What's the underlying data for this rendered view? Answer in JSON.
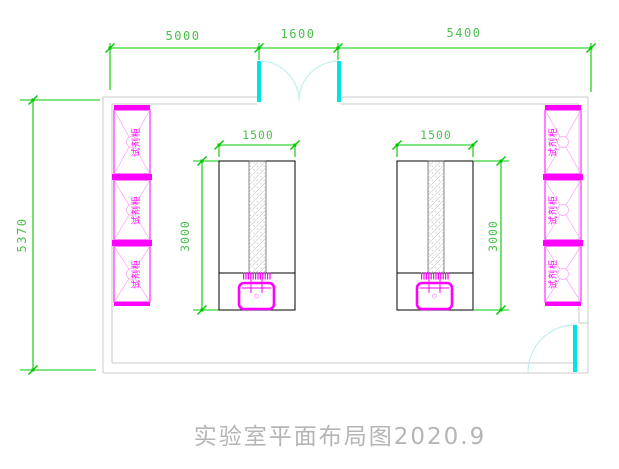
{
  "drawing": {
    "title": "实验室平面布局图2020.9",
    "dimensions": {
      "top_left": "5000",
      "top_middle": "1600",
      "top_right": "5400",
      "left_height": "5370",
      "bench_left_width": "1500",
      "bench_left_depth": "3000",
      "bench_right_width": "1500",
      "bench_right_depth": "3000"
    },
    "cabinet_labels": {
      "left": [
        "试剂柜",
        "试剂柜",
        "试剂柜"
      ],
      "right": [
        "试剂柜",
        "试剂柜",
        "试剂柜"
      ]
    },
    "colors": {
      "dimension_green": "#00c800",
      "cabinet_magenta": "#ff00ff",
      "door_cyan": "#00e3e3",
      "door_arc_cyan": "#c2f0ef",
      "wall_gray": "#cbcbcb",
      "bench_black": "#000000",
      "title_gray": "#b5b5b5",
      "background": "#ffffff"
    }
  }
}
